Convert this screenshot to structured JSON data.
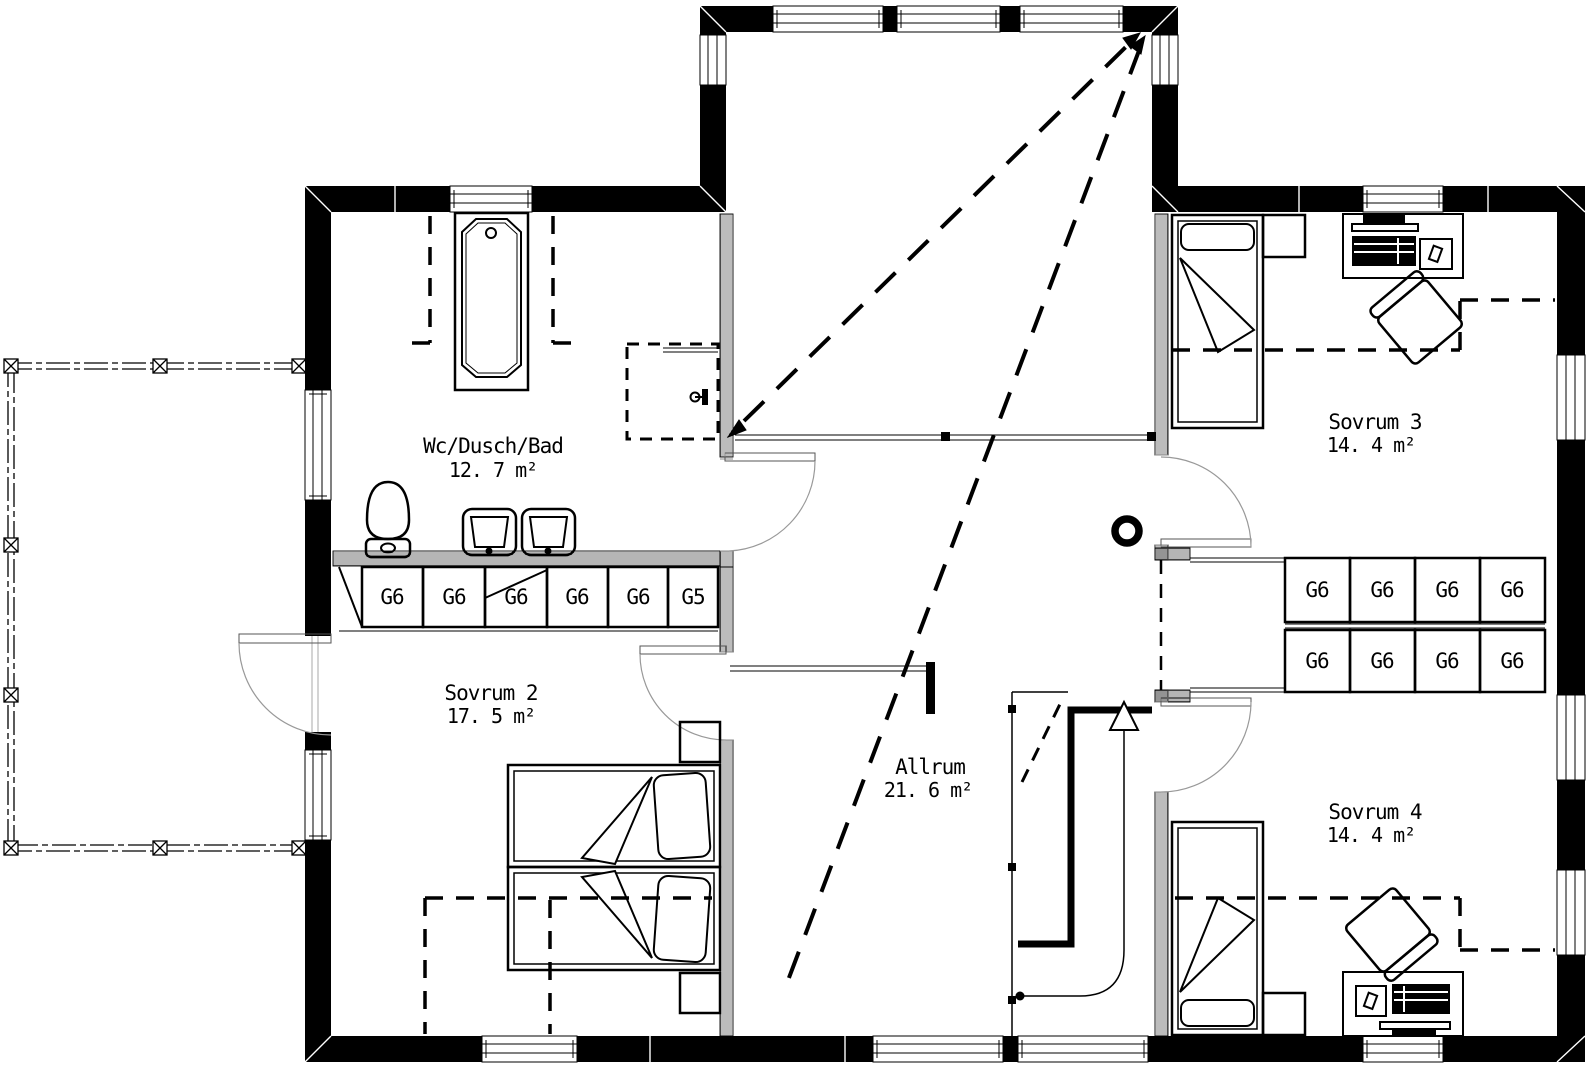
{
  "plan": {
    "title": "Floor plan – upper storey",
    "rooms": {
      "bathroom": {
        "name": "Wc/Dusch/Bad",
        "area": "12. 7 m²"
      },
      "bedroom2": {
        "name": "Sovrum 2",
        "area": "17. 5 m²"
      },
      "allrum": {
        "name": "Allrum",
        "area": "21. 6 m²"
      },
      "bedroom3": {
        "name": "Sovrum 3",
        "area": "14. 4 m²"
      },
      "bedroom4": {
        "name": "Sovrum 4",
        "area": "14. 4 m²"
      }
    },
    "closets": {
      "bathroom_row": [
        "G6",
        "G6",
        "G6",
        "G6",
        "G6",
        "G5"
      ],
      "hall_top": [
        "G6",
        "G6",
        "G6",
        "G6"
      ],
      "hall_bottom": [
        "G6",
        "G6",
        "G6",
        "G6"
      ]
    },
    "colors": {
      "line": "#000000",
      "door": "#999999",
      "background": "#ffffff"
    }
  }
}
